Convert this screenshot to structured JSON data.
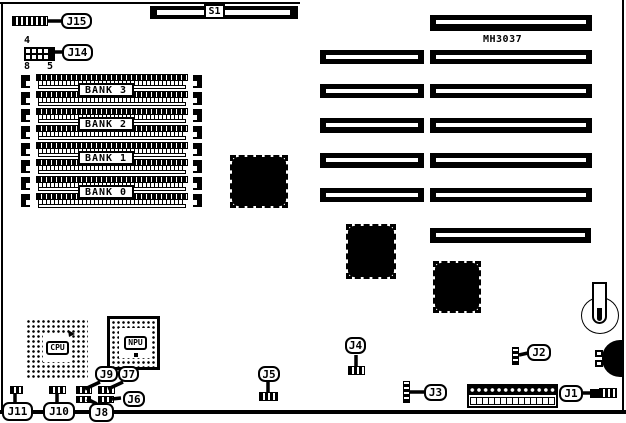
{
  "colors": {
    "ink": "#000000",
    "paper": "#ffffff"
  },
  "board": {
    "model": "MH3037",
    "switch_label": "S1"
  },
  "memory": {
    "bank_labels": [
      "BANK 3",
      "BANK 2",
      "BANK 1",
      "BANK 0"
    ]
  },
  "sockets": {
    "cpu_label": "CPU",
    "npu_label": "NPU"
  },
  "callouts": {
    "j1": "J1",
    "j2": "J2",
    "j3": "J3",
    "j4": "J4",
    "j5": "J5",
    "j6": "J6",
    "j7": "J7",
    "j8": "J8",
    "j9": "J9",
    "j10": "J10",
    "j11": "J11",
    "j14": "J14",
    "j15": "J15"
  },
  "j14_pins": {
    "top": "4",
    "bottom_left": "8",
    "bottom_right": "5"
  }
}
